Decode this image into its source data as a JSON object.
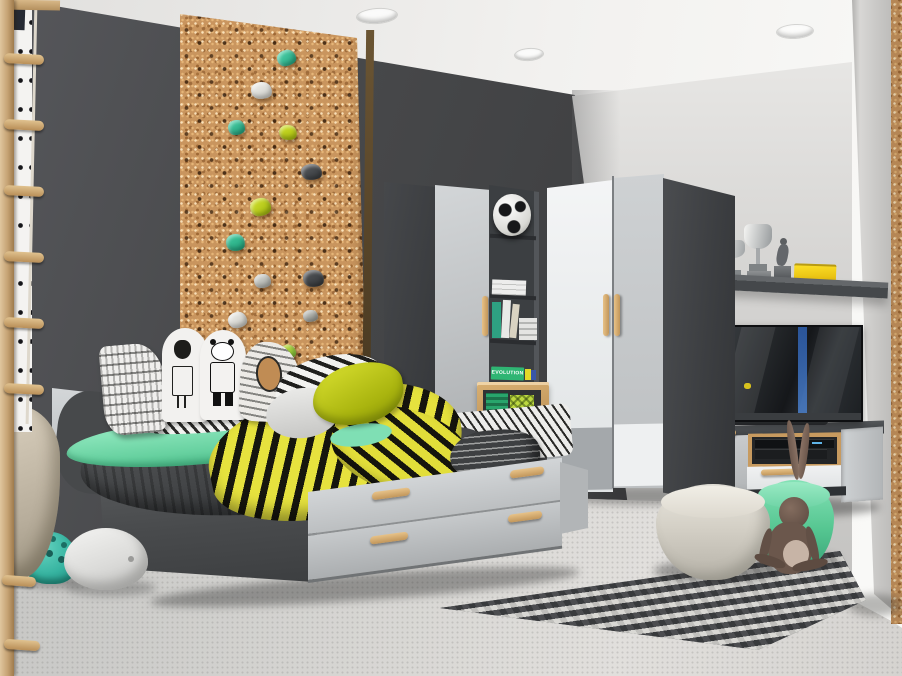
{
  "scene": {
    "type": "natural-image",
    "description": "Photorealistic render of a kids bedroom: charcoal feature wall with cork climbing panel and rope ladder, bed with trundle drawers and striped bedding, doodle pillows, corner wardrobe in white and grey with wooden handles, open shelf unit with football and books, wall shelf with trophies and yellow box, TV on a floating media unit, chevron rug, knitted poufs, bunny toy and floor toys.",
    "labels": {
      "book_spine": "EVOLUTION"
    },
    "palette": {
      "wall_dark": "#434547",
      "wall_light": "#cbcac8",
      "ceiling": "#f2f1ef",
      "floor": "#d5d4d1",
      "cork": "#c9955e",
      "furniture_dark": "#46484b",
      "furniture_light": "#c7cacc",
      "furniture_white": "#edeff0",
      "wood_handle": "#d2a76a",
      "accent_mint": "#7fdfb4",
      "accent_yellow": "#dfe03a",
      "accent_teal": "#3fc0a5",
      "pouf_green": "#62cf9e",
      "pouf_cream": "#d8d4ca",
      "bunny_brown": "#6b574c",
      "rug_dark": "#404244",
      "rug_light": "#d2d2ce",
      "tv_screen": "#202326",
      "trophy_silver": "#b9bcbe",
      "box_yellow": "#edc713"
    },
    "objects": [
      {
        "name": "rope-ladder",
        "desc": "wooden wall bars with rope ladder rungs, far left"
      },
      {
        "name": "climbing-wall",
        "desc": "cork pegboard panel with teal, lime, white and grey climbing holds"
      },
      {
        "name": "bed",
        "desc": "single bed with grey trundle drawers and wooden handles"
      },
      {
        "name": "bedding",
        "desc": "mint, dark grey and yellow-black striped blankets with doodle pillows"
      },
      {
        "name": "shelf-unit",
        "desc": "dark open shelf unit with football, books and green EVOLUTION book"
      },
      {
        "name": "corner-wardrobe",
        "desc": "white and grey two-door corner wardrobe with wooden handles"
      },
      {
        "name": "wall-shelf",
        "desc": "dark floating shelf with two silver trophies, figurine and yellow box"
      },
      {
        "name": "tv-unit",
        "desc": "floating media cabinet with oak niche, AV devices and flat TV"
      },
      {
        "name": "rug",
        "desc": "black and white chevron rug"
      },
      {
        "name": "poufs",
        "desc": "cream knitted pouf and mint green pouf"
      },
      {
        "name": "bunny-toy",
        "desc": "brown long-eared bunny doll"
      },
      {
        "name": "floor-toys",
        "desc": "teal helmet and white rocking bowl toy"
      }
    ]
  }
}
